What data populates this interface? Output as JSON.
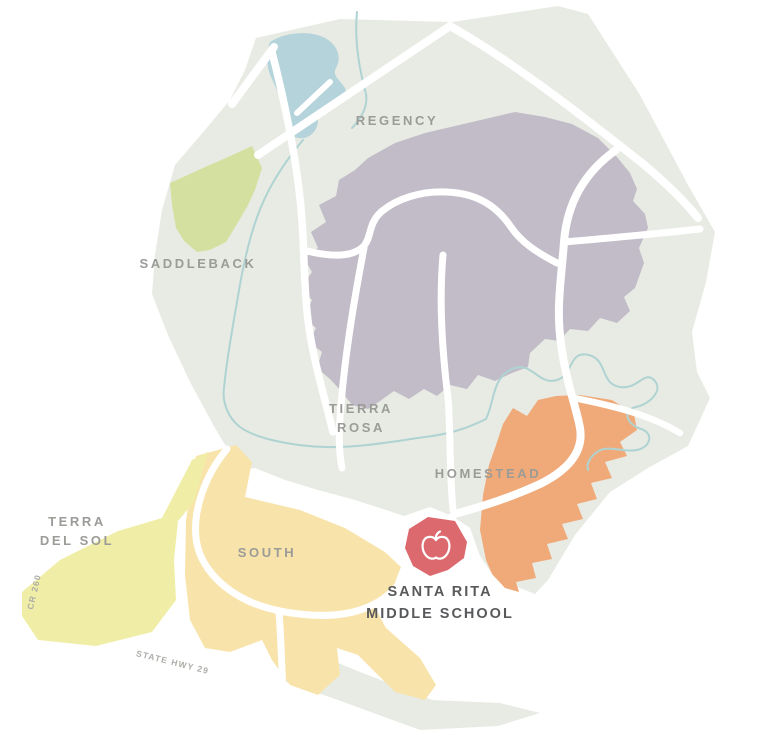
{
  "map": {
    "colors": {
      "page_bg": "#ffffff",
      "land": "#e8ebe4",
      "road": "#ffffff",
      "stream": "#aed3d2",
      "lake": "#b4d3da",
      "region_label": "#9b9b97",
      "road_label": "#acaca8",
      "school_label": "#58595b",
      "school_zone": "#dc696e",
      "school_icon": "#ffffff",
      "saddleback_fill": "#d4e0a0",
      "tierra_rosa_fill": "#c1bcc7",
      "homestead_fill": "#f0aa79",
      "terra_del_sol_fill": "#f0eea6",
      "south_fill": "#f8e4aa"
    },
    "regions": [
      {
        "id": "regency",
        "label": "REGENCY"
      },
      {
        "id": "saddleback",
        "label": "SADDLEBACK"
      },
      {
        "id": "tierra-rosa",
        "label_line1": "TIERRA",
        "label_line2": "ROSA"
      },
      {
        "id": "homestead",
        "label": "HOMESTEAD"
      },
      {
        "id": "terra-del-sol",
        "label_line1": "TERRA",
        "label_line2": "DEL SOL"
      },
      {
        "id": "south",
        "label": "SOUTH"
      }
    ],
    "school": {
      "label_line1": "SANTA RITA",
      "label_line2": "MIDDLE SCHOOL",
      "icon": "apple-icon"
    },
    "road_labels": [
      {
        "id": "cr-260",
        "label": "CR 260"
      },
      {
        "id": "state-hwy-29",
        "label": "STATE HWY 29"
      }
    ]
  }
}
